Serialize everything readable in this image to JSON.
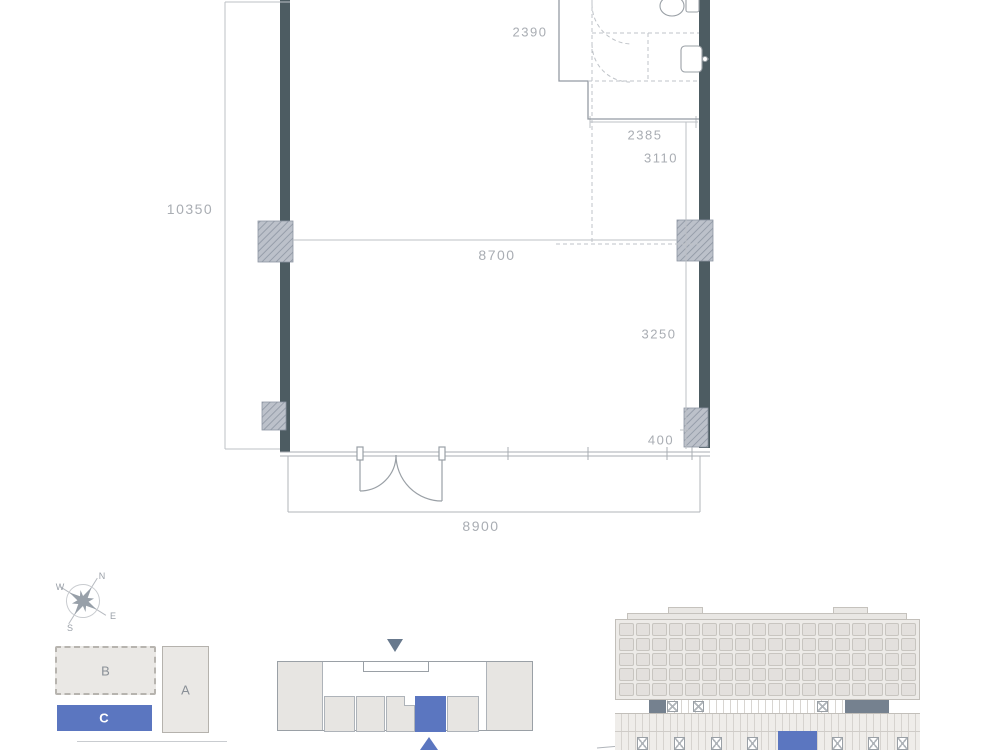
{
  "floor_plan": {
    "dimensions": {
      "top_width": "2390",
      "bath_width": "2385",
      "upper_right_height": "3110",
      "left_height": "10350",
      "interior_width": "8700",
      "lower_right_height": "3250",
      "right_offset": "400",
      "overall_width": "8900"
    }
  },
  "compass": {
    "north_label": "N",
    "east_label": "E",
    "south_label": "S",
    "west_label": "W"
  },
  "site_plan": {
    "block_b_label": "B",
    "block_a_label": "A",
    "block_c_label": "C",
    "highlighted_block": "C"
  },
  "key_plan": {
    "unit_count": 5,
    "highlighted_unit": 4
  },
  "elevation": {
    "window_rows": 5,
    "window_cols": 18
  },
  "colors": {
    "wall_dark": "#4d5c62",
    "accent_blue": "#5b76c0",
    "dim_text": "#a9adb3",
    "block_gray": "#e9e7e4",
    "slate_gray": "#75818f"
  }
}
